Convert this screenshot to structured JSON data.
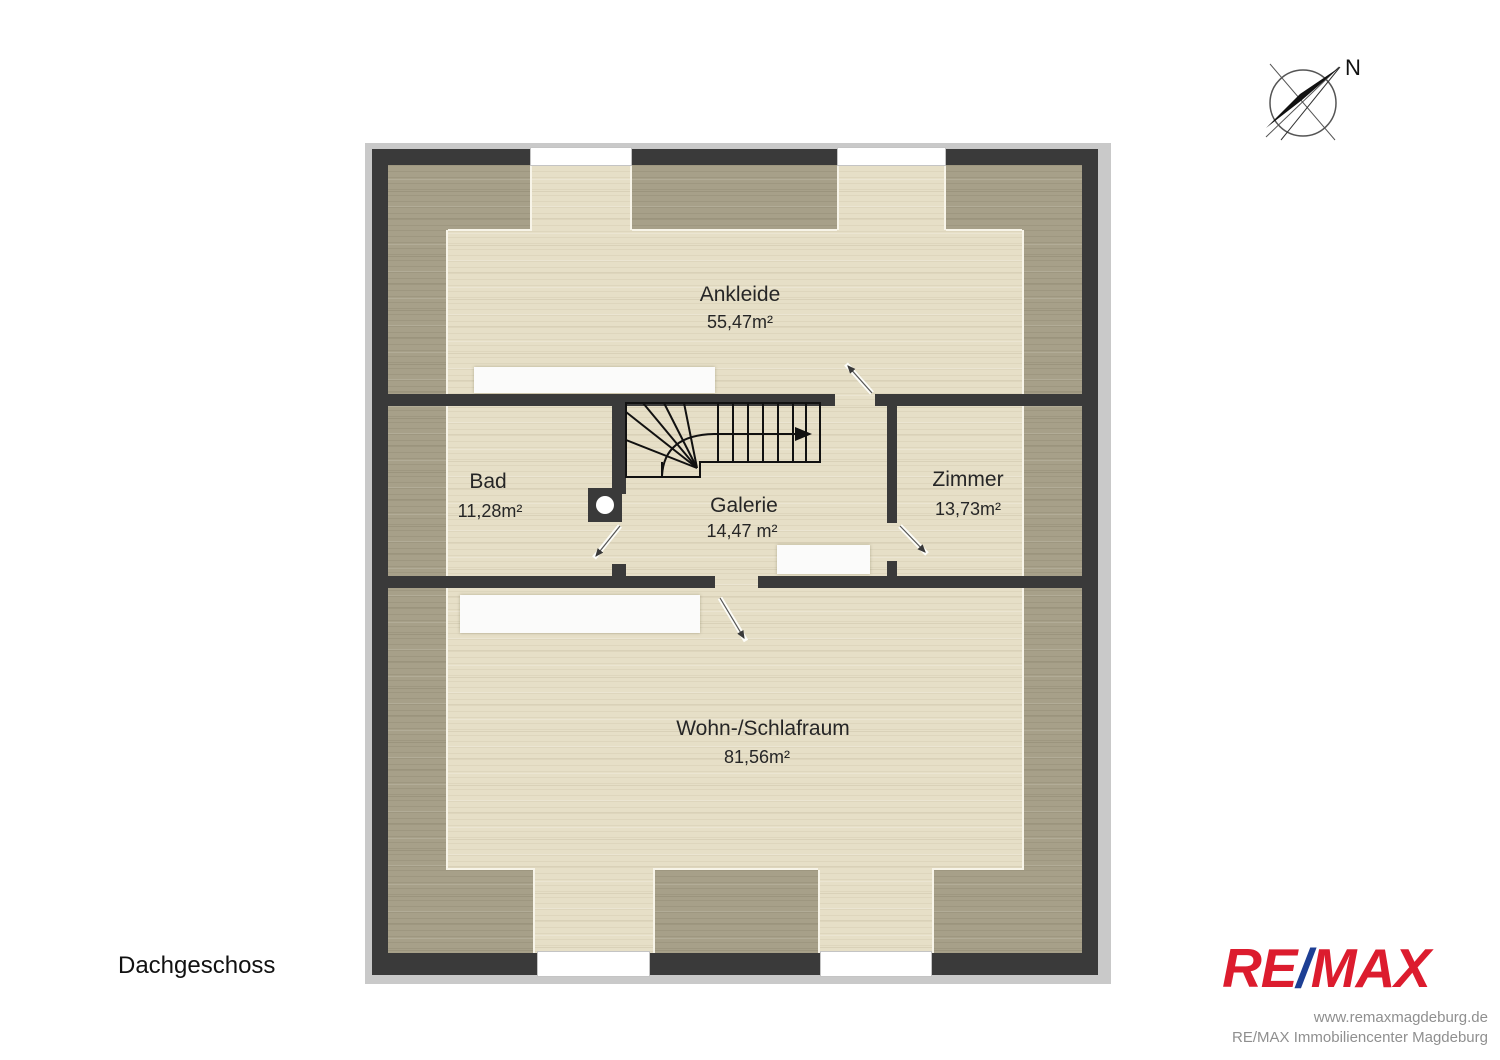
{
  "title_block": {
    "floor_label": "Dachgeschoss"
  },
  "compass": {
    "north_label": "N"
  },
  "rooms": [
    {
      "name": "Ankleide",
      "area": "55,47m²"
    },
    {
      "name": "Bad",
      "area": "11,28m²"
    },
    {
      "name": "Galerie",
      "area": "14,47 m²"
    },
    {
      "name": "Zimmer",
      "area": "13,73m²"
    },
    {
      "name": "Wohn-/Schlafraum",
      "area": "81,56m²"
    }
  ],
  "branding": {
    "logo_re": "RE",
    "logo_slash": "/",
    "logo_max": "MAX",
    "logo_red": "#dc1c2e",
    "logo_blue": "#1d3f94",
    "website": "www.remaxmagdeburg.de",
    "company": "RE/MAX Immobiliencenter Magdeburg"
  },
  "palette": {
    "wall": "#3a3a3a",
    "floor_light": "#e6dfc7",
    "floor_low_height_zone": "#a7a089",
    "plan_shadow": "#c9c9c9",
    "window": "#ffffff"
  }
}
